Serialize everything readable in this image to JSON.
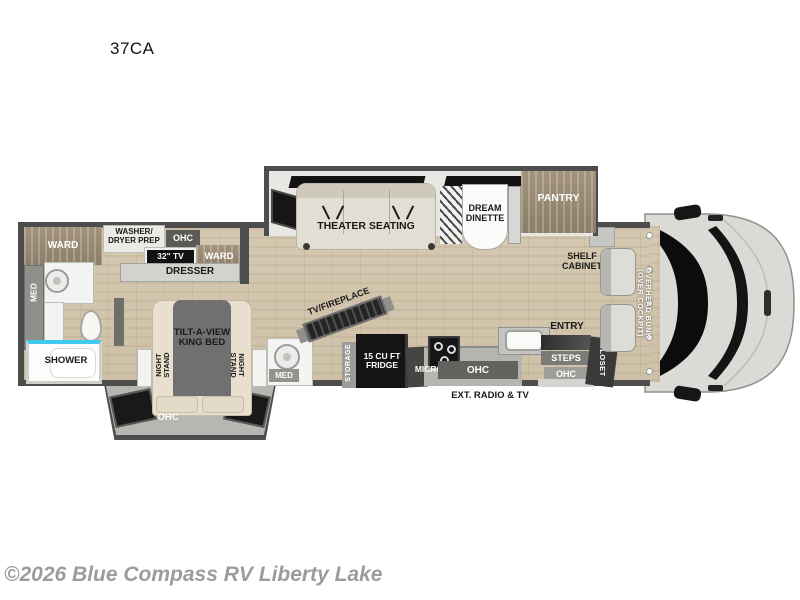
{
  "title": "37CA",
  "watermark": "©2026 Blue Compass RV Liberty Lake",
  "colors": {
    "wall": "#4d4d4d",
    "floor_wood": "#d2c5ac",
    "cabinet_wood": "#9a8a74",
    "shower_accent": "#3fc9ec",
    "appliance_black": "#141414",
    "badge_gray": "#5c5c5c",
    "watermark_gray": "#9c9c9c"
  },
  "labels": {
    "ward": "WARD",
    "washer1": "WASHER/",
    "washer2": "DRYER PREP",
    "ohc": "OHC",
    "tv32": "32\" TV",
    "dresser": "DRESSER",
    "med": "MED",
    "shower": "SHOWER",
    "theater": "THEATER SEATING",
    "dream1": "DREAM",
    "dream2": "DINETTE",
    "pantry": "PANTRY",
    "shelf1": "SHELF",
    "shelf2": "CABINET",
    "bunk1": "OVERHEAD BUNK",
    "bunk2": "(OVER COCKPIT)",
    "bed1": "TILT-A-VIEW",
    "bed2": "KING BED",
    "night1": "NIGHT",
    "night2": "STAND",
    "tvfire": "TV/FIREPLACE",
    "storage": "STORAGE",
    "fridge1": "15 CU FT",
    "fridge2": "FRIDGE",
    "micro": "MICRO",
    "entry": "ENTRY",
    "steps": "STEPS",
    "closet": "CLOSET",
    "extradio": "EXT. RADIO & TV"
  }
}
